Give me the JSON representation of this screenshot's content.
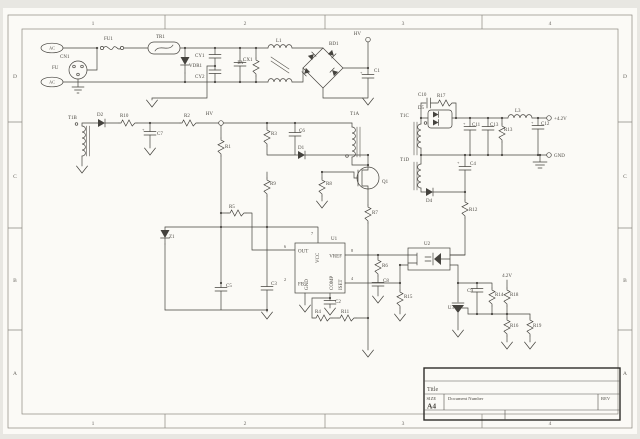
{
  "sheet": {
    "zones_horizontal": [
      "1",
      "2",
      "3",
      "4"
    ],
    "zones_vertical": [
      "D",
      "C",
      "B",
      "A"
    ],
    "colors": {
      "paper": "#fbfaf6",
      "background": "#e8e7e2",
      "ink": "#45433e",
      "text": "#4d4a44"
    }
  },
  "title_block": {
    "title_label": "Title",
    "size_label": "SIZE",
    "size_value": "A4",
    "document_label": "Document Number",
    "rev_label": "REV"
  },
  "rails": {
    "hv_bulk": "HV",
    "hv_tap": "HV",
    "vout": "+4.2V",
    "gnd_out": "GND",
    "fb_ref": "4.2V",
    "plus": "+"
  },
  "labels": {
    "ac_top": "AC",
    "ac_bottom": "AC",
    "cn1": "CN1",
    "fu": "FU",
    "fu1": "FU1",
    "tr1": "TR1",
    "vdr1": "VDR1",
    "cy1": "CY1",
    "cy2": "CY2",
    "cx1": "CX1",
    "ry": "RY",
    "l1": "L1",
    "bd1": "BD1",
    "c1": "C1",
    "t1b": "T1B",
    "d2": "D2",
    "r10": "R10",
    "c7": "C7",
    "r2": "R2",
    "r1": "R1",
    "r5": "R5",
    "z1": "Z1",
    "c5": "C5",
    "c3": "C3",
    "r3": "R3",
    "c6": "C6",
    "d1": "D1",
    "t1a": "T1A",
    "q1": "Q1",
    "r9": "R9",
    "r8": "R8",
    "r7": "R7",
    "c2": "C2",
    "r4": "R4",
    "r11": "R11",
    "r6": "R6",
    "c8": "C8",
    "r15": "R15",
    "u2": "U2",
    "u3": "U3",
    "t1c": "T1C",
    "c10": "C10",
    "r17": "R17",
    "d5": "D5",
    "c11": "C11",
    "c13": "C13",
    "r13": "R13",
    "l3": "L3",
    "c12": "C12",
    "t1d": "T1D",
    "d4": "D4",
    "c4": "C4",
    "r12": "R12",
    "c9": "C9",
    "r14": "R14",
    "r18": "R18",
    "r16": "R16",
    "r19": "R19"
  },
  "u1": {
    "ref": "U1",
    "pins": {
      "out": "OUT",
      "vcc": "VCC",
      "vref": "VREF",
      "fb": "FB",
      "gnd": "GND",
      "comp": "COMP",
      "iset": "ISET"
    },
    "pin_numbers": {
      "out": "6",
      "vcc": "7",
      "vref": "8",
      "fb": "2",
      "iset": "4"
    }
  }
}
